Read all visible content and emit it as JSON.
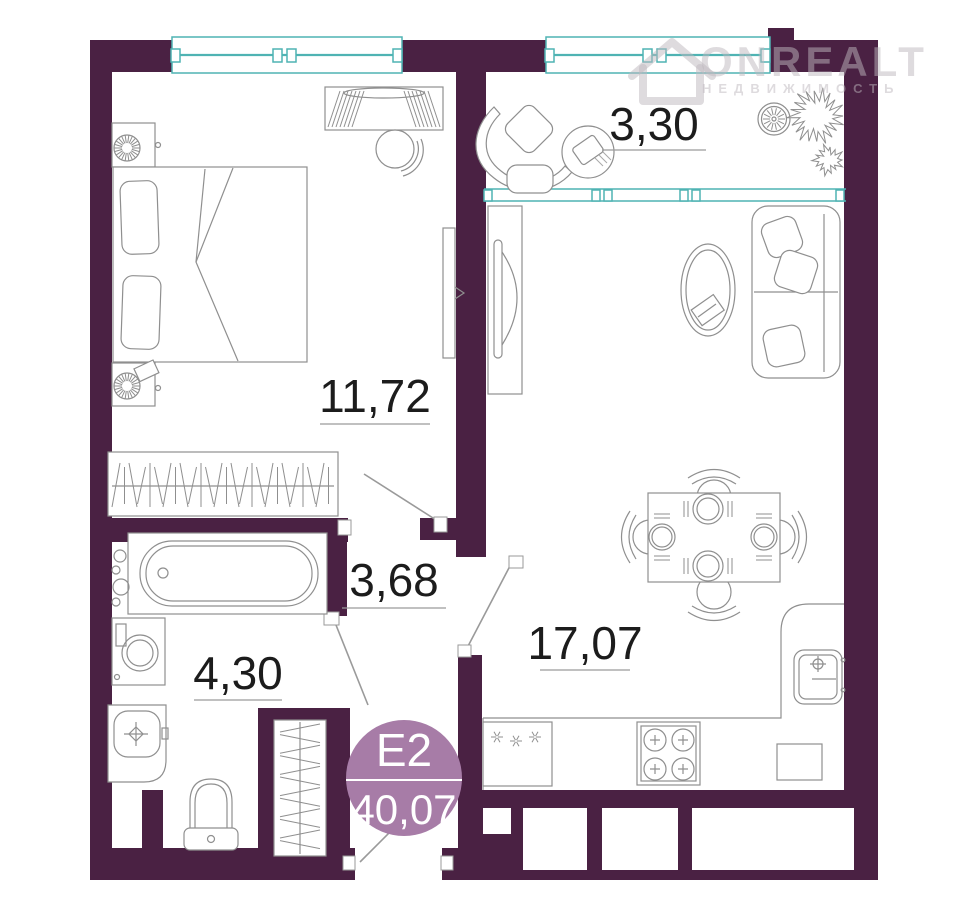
{
  "watermark": {
    "brand": "ONREALT",
    "tagline": "НЕДВИЖИМОСТЬ"
  },
  "unit": {
    "code": "Е2",
    "total_area": "40,07"
  },
  "rooms": {
    "balcony": {
      "area": "3,30"
    },
    "bedroom": {
      "area": "11,72"
    },
    "hallway": {
      "area": "3,68"
    },
    "bathroom": {
      "area": "4,30"
    },
    "living_kitchen": {
      "area": "17,07"
    }
  },
  "colors": {
    "wall": "#4a2143",
    "window": "#4fb3b3",
    "badge": "#a77ca7",
    "label_text": "#1c1c1c",
    "furniture_line": "#8f8f8f",
    "watermark": "rgba(190,184,190,0.5)"
  }
}
